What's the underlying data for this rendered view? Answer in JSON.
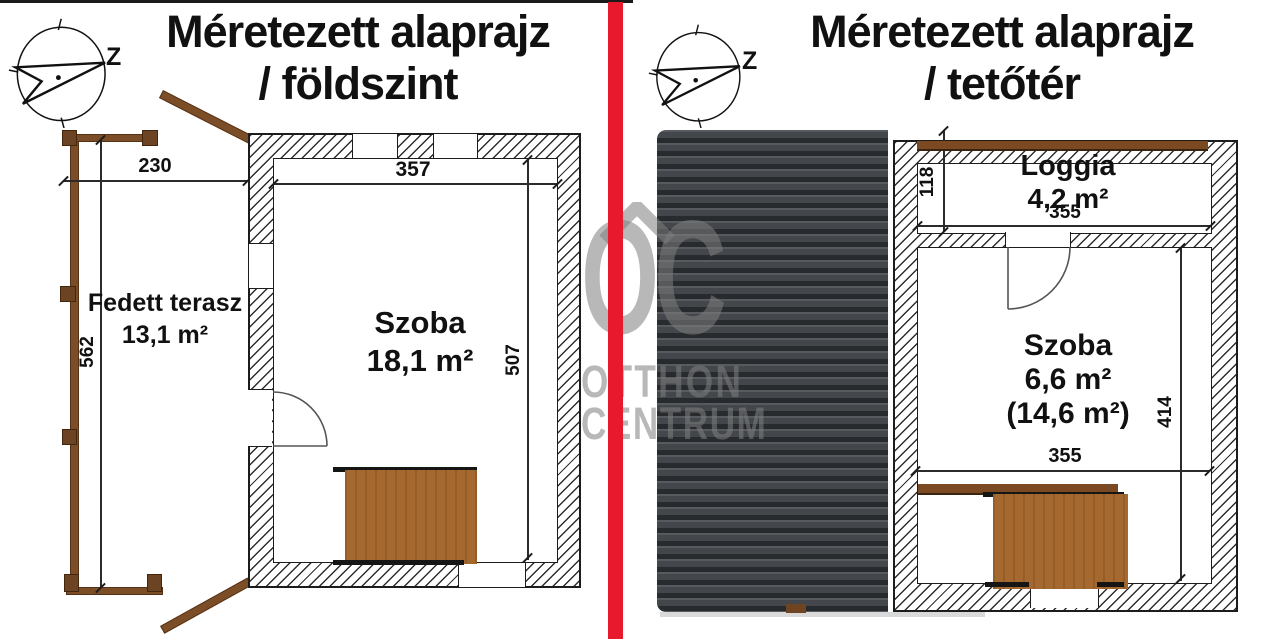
{
  "colors": {
    "divider_red": "#e8192c",
    "rail_brown": "#7b4e28",
    "post_brown": "#6d4423",
    "stair_brown": "#a5692f",
    "roof_base": "#3d4044",
    "watermark_gray": "#7f7f7f"
  },
  "watermark": {
    "logo": "OC",
    "line1": "OTTHON",
    "line2": "CENTRUM"
  },
  "left_plan": {
    "title_line1": "Méretezett alaprajz",
    "title_line2": "/ földszint",
    "compass_label": "Z",
    "terrace": {
      "name": "Fedett terasz",
      "area": "13,1 m²",
      "width_cm": "230",
      "depth_cm": "562"
    },
    "room": {
      "name": "Szoba",
      "area": "18,1 m²",
      "width_cm": "357",
      "depth_cm": "507"
    }
  },
  "right_plan": {
    "title_line1": "Méretezett alaprajz",
    "title_line2": "/ tetőtér",
    "compass_label": "Z",
    "loggia": {
      "name": "Loggia",
      "area": "4,2 m²",
      "width_cm": "355",
      "depth_cm": "118"
    },
    "room": {
      "name": "Szoba",
      "area": "6,6 m²",
      "area_total": "(14,6 m²)",
      "width_cm": "355",
      "depth_cm": "414"
    }
  }
}
